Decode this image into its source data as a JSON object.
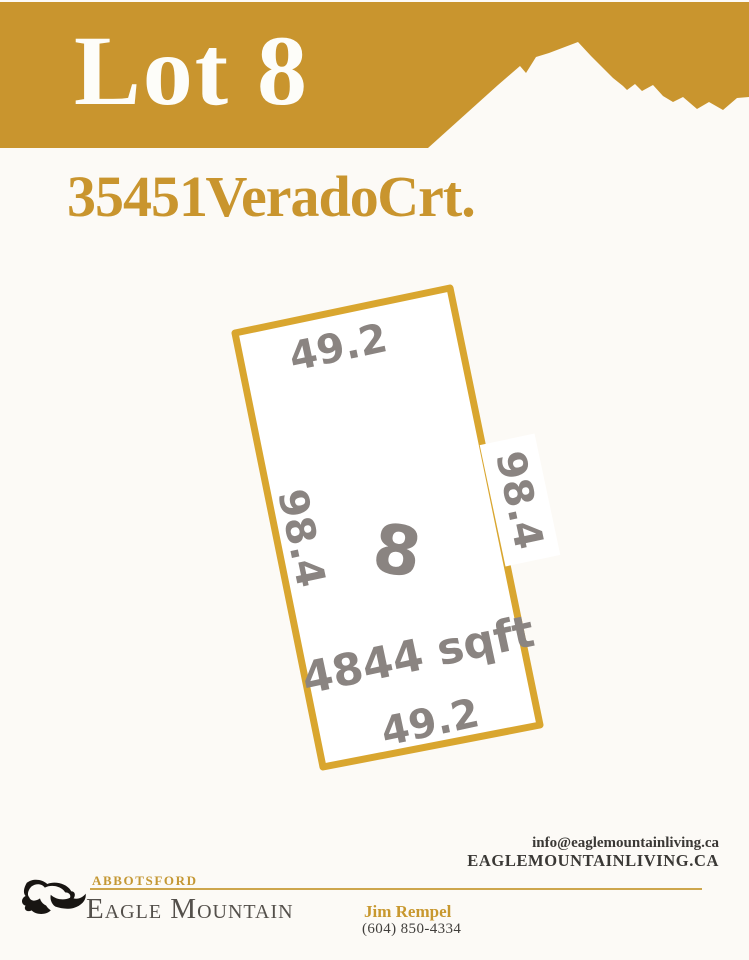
{
  "banner": {
    "title": "Lot 8"
  },
  "address": "35451 Verado Crt.",
  "lot": {
    "number": "8",
    "area": "4844 sqft",
    "dim_top": "49.2",
    "dim_bottom": "49.2",
    "dim_left": "98.4",
    "dim_right": "98.4"
  },
  "contact": {
    "email": "info@eaglemountainliving.ca",
    "website": "EAGLEMOUNTAINLIVING.CA"
  },
  "footer": {
    "city": "ABBOTSFORD",
    "brand": "Eagle Mountain",
    "agent_name": "Jim Rempel",
    "agent_phone": "(604) 850-4334"
  },
  "colors": {
    "banner_gold": "#C9952E",
    "lot_outline_gold": "#D9A62F",
    "dim_text_gray": "#8A8481",
    "footer_gold": "#C49733",
    "dark_text": "#3A3835"
  }
}
